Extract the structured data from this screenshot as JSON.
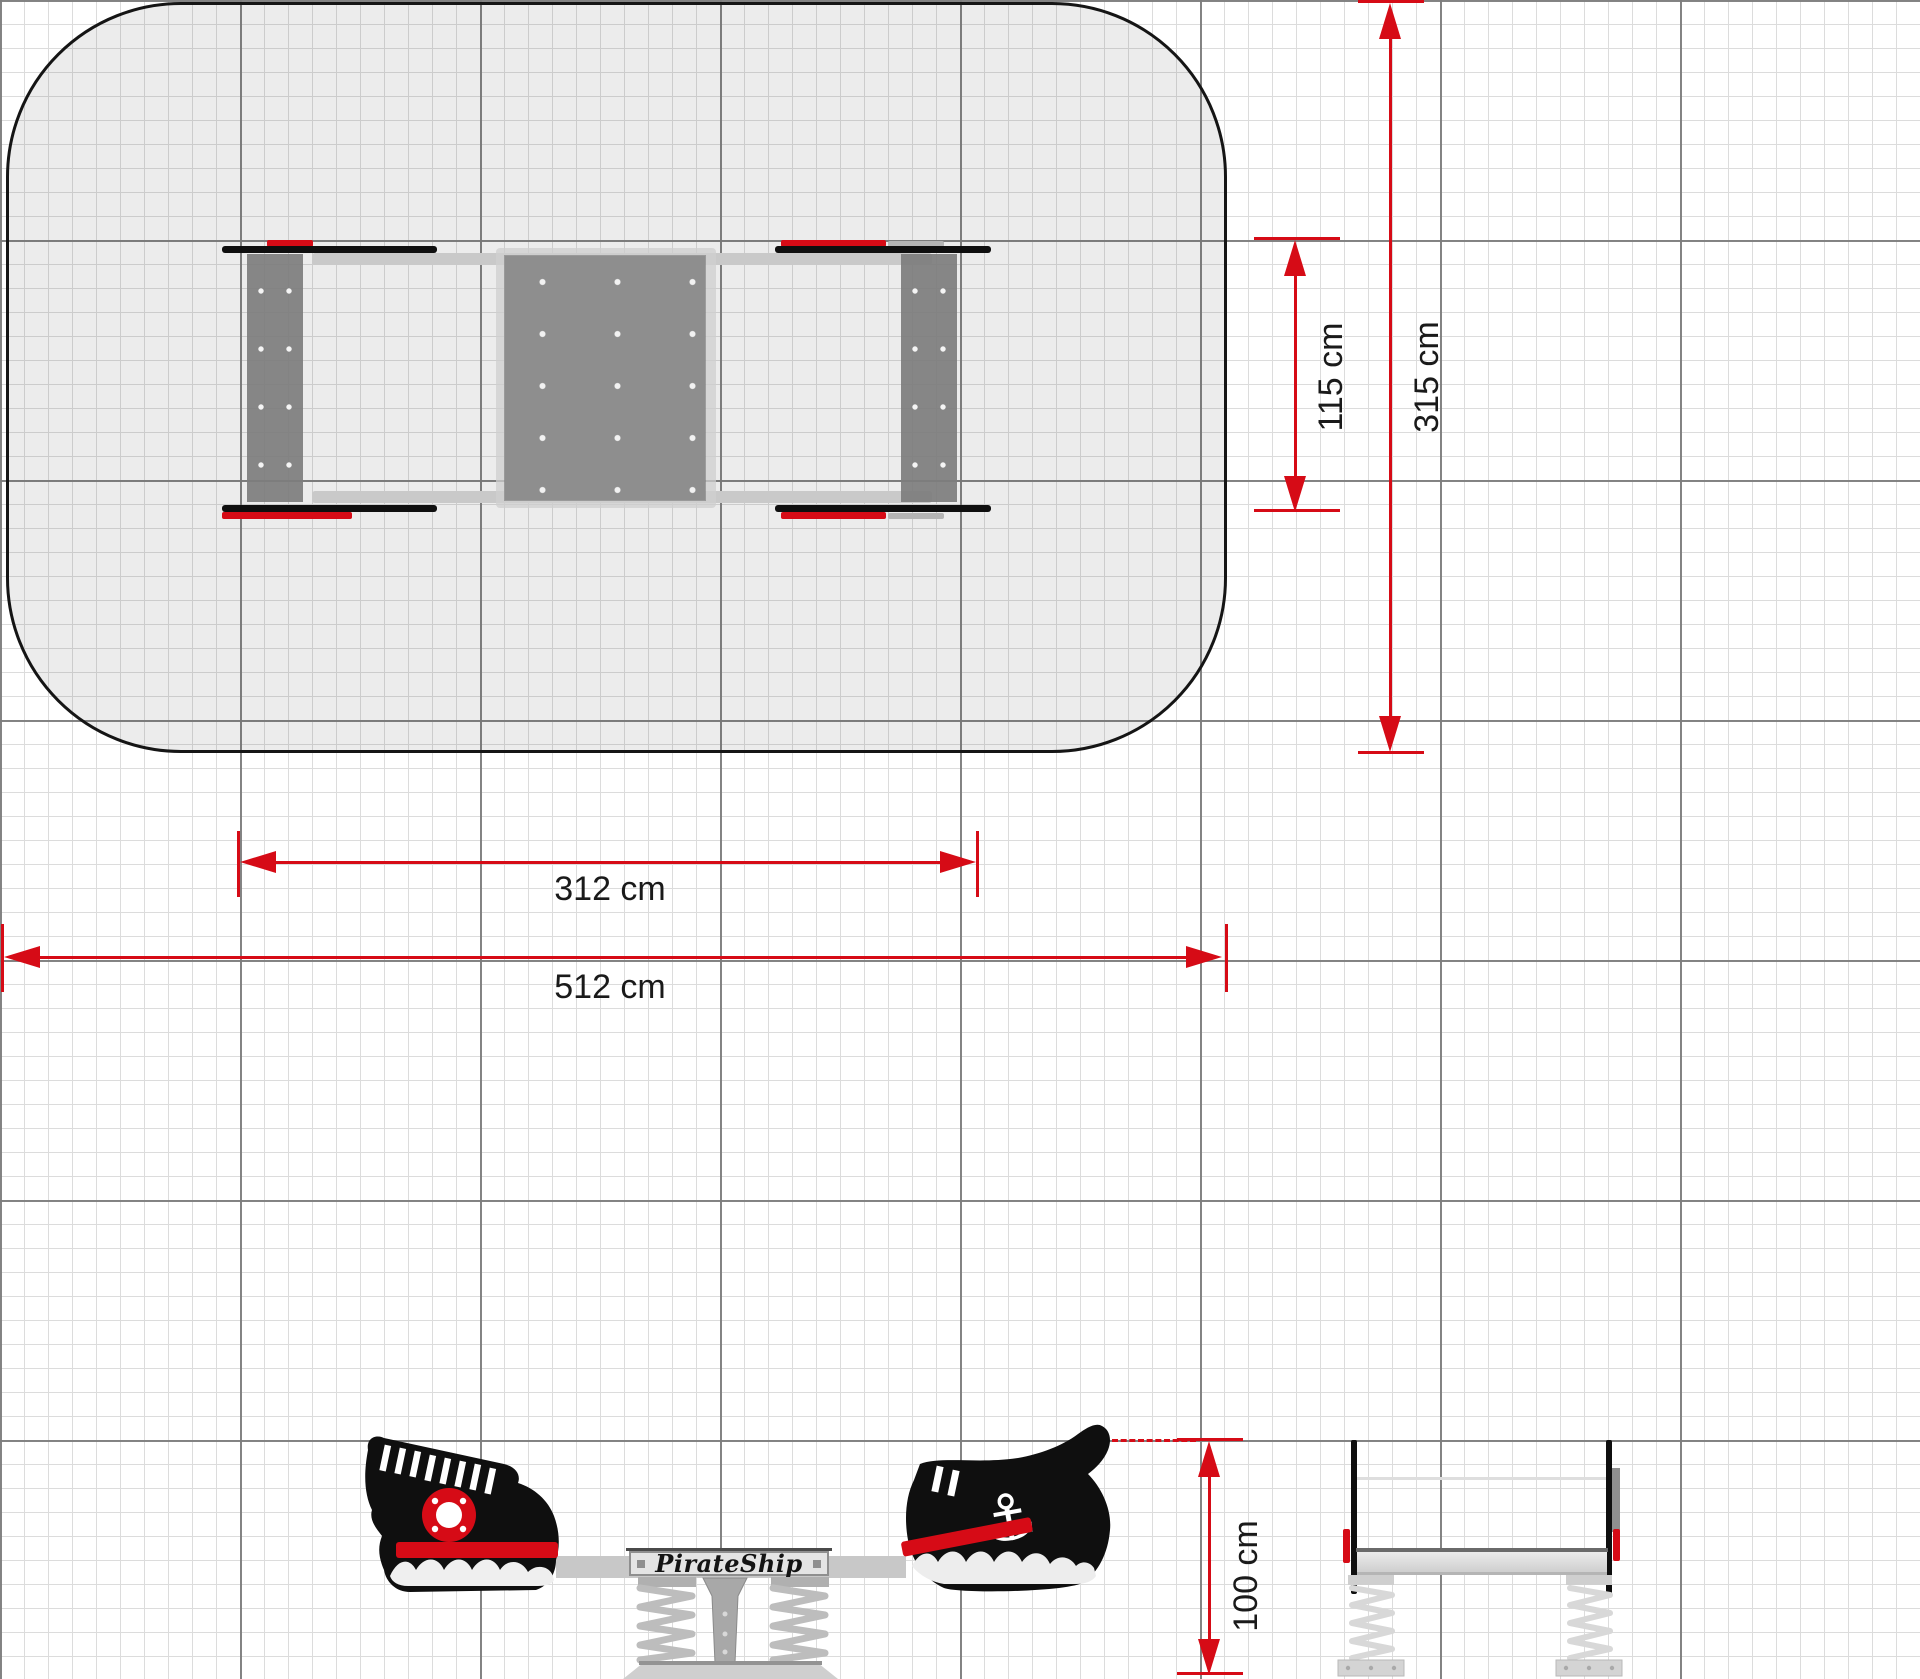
{
  "drawing": {
    "brand_label": "PirateShip",
    "dimensions": {
      "equipment_width": "115 cm",
      "safety_area_width": "315 cm",
      "equipment_length": "312 cm",
      "safety_area_length": "512 cm",
      "equipment_height": "100 cm"
    },
    "icons": {
      "anchor_glyph": "⚓"
    },
    "colors": {
      "dimension_red": "#d60b16",
      "silhouette_black": "#0f0f0f",
      "safety_area_fill": "#e9e9e9",
      "metal_light": "#c8c8c8",
      "metal_mid": "#a8a8a8",
      "panel_gray": "#8e8e8e",
      "grid_minor": "#dcdcdc",
      "grid_major": "#7d7d7d"
    }
  }
}
